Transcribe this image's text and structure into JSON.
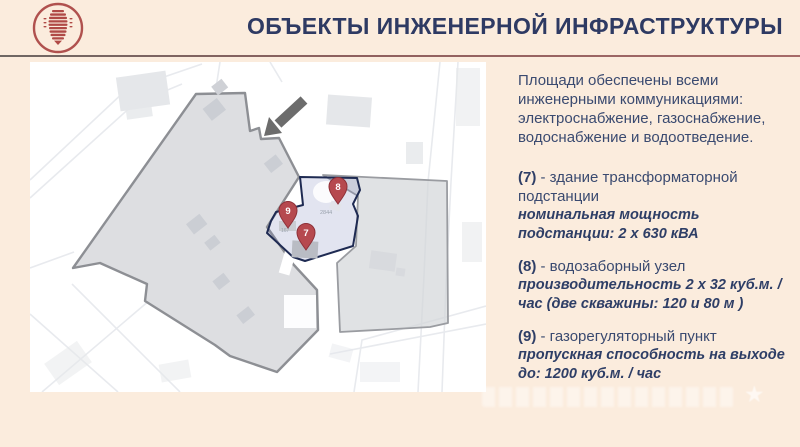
{
  "header": {
    "title": "ОБЪЕКТЫ ИНЖЕНЕРНОЙ ИНФРАСТРУКТУРЫ"
  },
  "panel": {
    "intro": "Площади обеспечены всеми инженерными коммуникациями: электроснабжение, газоснабжение, водоснабжение и водоотведение.",
    "items": [
      {
        "num": "(7)",
        "desc": "- здание трансформаторной подстанции",
        "spec": "номинальная мощность подстанции: 2 х 630 кВА"
      },
      {
        "num": "(8)",
        "desc": "- водозаборный узел",
        "spec": "производительность 2 х 32 куб.м. / час (две скважины: 120 и 80 м )"
      },
      {
        "num": "(9)",
        "desc": "- газорегуляторный пункт",
        "spec": "пропускная способность на выходе до: 1200 куб.м. / час"
      }
    ]
  },
  "map": {
    "pins": [
      {
        "label": "7"
      },
      {
        "label": "8"
      },
      {
        "label": "9"
      }
    ],
    "parcel_labels": [
      {
        "text": "2844"
      },
      {
        "text": "167"
      }
    ]
  },
  "icons": {
    "watermark_star": "★"
  },
  "colors": {
    "background": "#fbecdd",
    "accent_navy": "#2e3a63",
    "accent_red": "#b04a46",
    "pin_red": "#b6494f",
    "territory_outline": "#8d8f94",
    "selection_outline": "#1e2a52"
  }
}
